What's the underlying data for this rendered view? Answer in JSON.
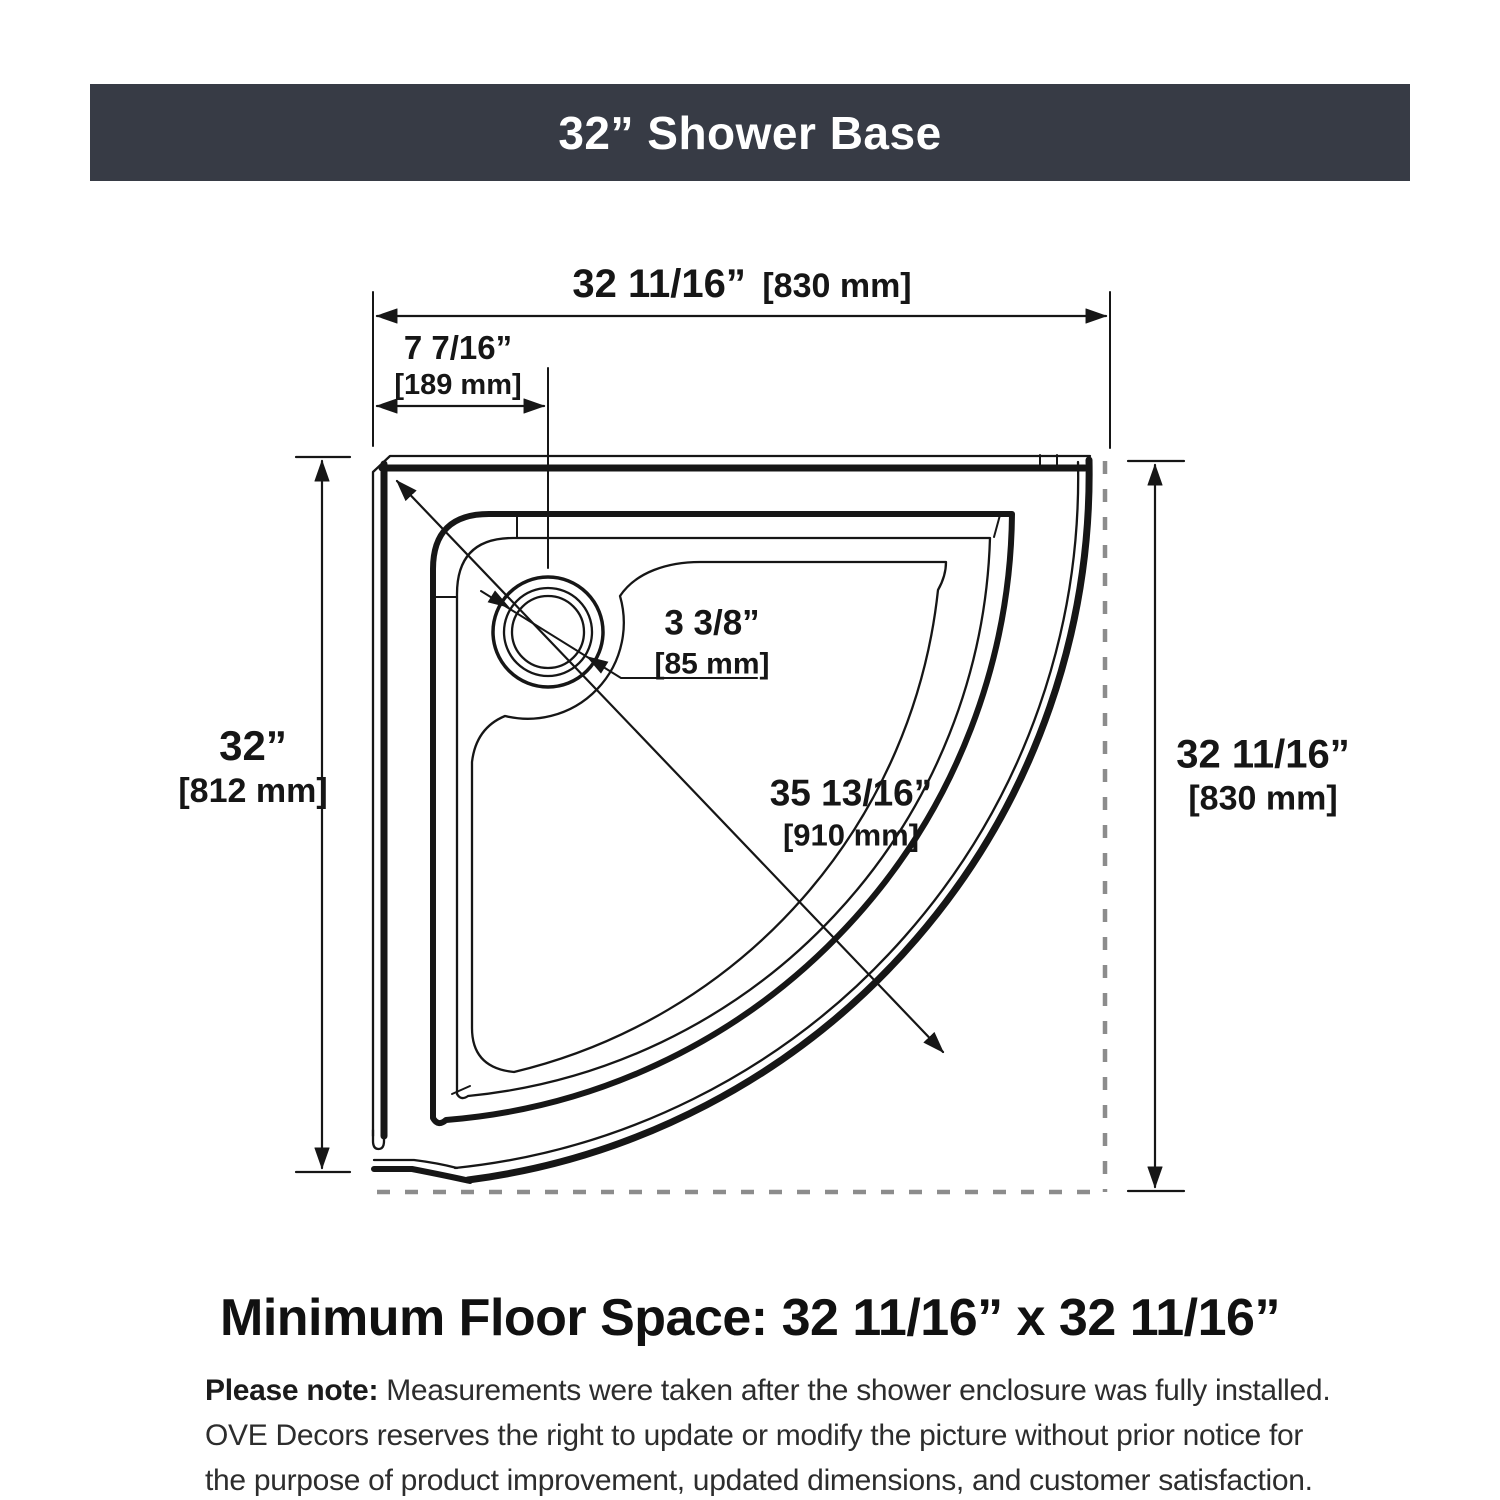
{
  "header": {
    "title": "32” Shower Base"
  },
  "diagram": {
    "dim_overall_width": {
      "in": "32 11/16”",
      "mm": "[830 mm]"
    },
    "dim_drain_offset": {
      "in": "7 7/16”",
      "mm": "[189 mm]"
    },
    "dim_drain_diameter": {
      "in": "3 3/8”",
      "mm": "[85 mm]"
    },
    "dim_diagonal": {
      "in": "35 13/16”",
      "mm": "[910 mm]"
    },
    "dim_left_height": {
      "in": "32”",
      "mm": "[812 mm]"
    },
    "dim_right_height": {
      "in": "32 11/16”",
      "mm": "[830 mm]"
    }
  },
  "footer": {
    "min_floor_space": "Minimum Floor Space: 32 11/16” x 32 11/16”",
    "note_label": "Please note:",
    "note_line1": "Measurements were taken after the shower enclosure was fully installed.",
    "note_line2": "OVE Decors reserves the right to update or modify the picture without prior notice for",
    "note_line3": "the purpose of product improvement, updated dimensions, and customer satisfaction."
  },
  "colors": {
    "header_bg": "#373b45",
    "header_fg": "#ffffff",
    "line": "#161616",
    "dashed_outline": "#8c8c8c"
  }
}
